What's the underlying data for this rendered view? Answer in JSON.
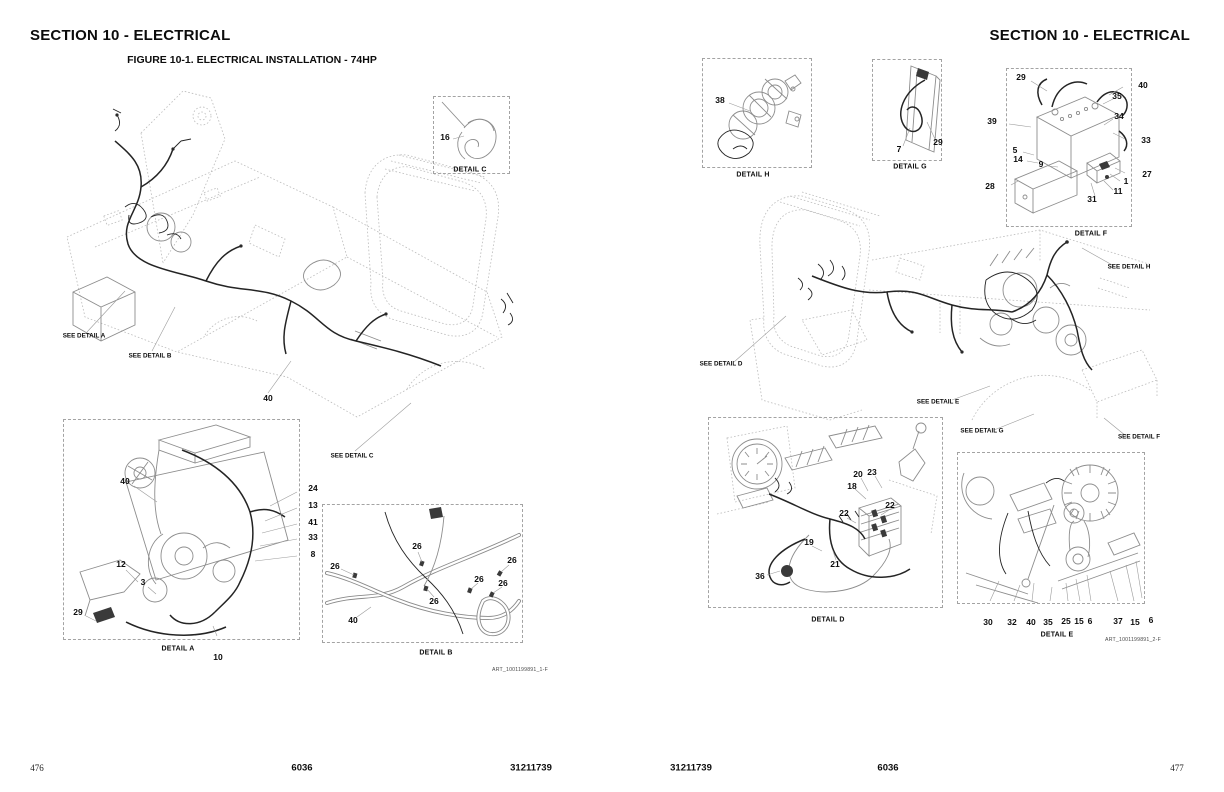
{
  "palette": {
    "paper": "#ffffff",
    "ink": "#0c0c0c",
    "diagram_gray": "#8d8d8d",
    "dashed_box_gray": "#a3a3a3",
    "harness_black": "#242424"
  },
  "left_page": {
    "header": "SECTION 10 - ELECTRICAL",
    "figure_title": "FIGURE 10-1. ELECTRICAL INSTALLATION - 74HP",
    "art_ref": "ART_1001199891_1-F",
    "footer": {
      "page": "476",
      "model": "6036",
      "part": "31211739"
    },
    "callouts": [
      {
        "t": "SEE DETAIL A",
        "x": 84,
        "y": 336,
        "k": "see"
      },
      {
        "t": "SEE DETAIL B",
        "x": 150,
        "y": 356,
        "k": "see"
      },
      {
        "t": "SEE DETAIL C",
        "x": 352,
        "y": 456,
        "k": "see"
      },
      {
        "t": "DETAIL C",
        "x": 470,
        "y": 170,
        "k": "cap"
      },
      {
        "t": "DETAIL A",
        "x": 178,
        "y": 649,
        "k": "cap"
      },
      {
        "t": "DETAIL B",
        "x": 436,
        "y": 653,
        "k": "cap"
      },
      {
        "t": "16",
        "x": 445,
        "y": 137
      },
      {
        "t": "40",
        "x": 268,
        "y": 398
      },
      {
        "t": "40",
        "x": 125,
        "y": 481
      },
      {
        "t": "24",
        "x": 313,
        "y": 488
      },
      {
        "t": "13",
        "x": 313,
        "y": 505
      },
      {
        "t": "41",
        "x": 313,
        "y": 522
      },
      {
        "t": "33",
        "x": 313,
        "y": 537
      },
      {
        "t": "8",
        "x": 313,
        "y": 554
      },
      {
        "t": "12",
        "x": 121,
        "y": 564
      },
      {
        "t": "3",
        "x": 143,
        "y": 582
      },
      {
        "t": "29",
        "x": 78,
        "y": 612
      },
      {
        "t": "10",
        "x": 218,
        "y": 657
      },
      {
        "t": "26",
        "x": 417,
        "y": 546
      },
      {
        "t": "26",
        "x": 335,
        "y": 566
      },
      {
        "t": "26",
        "x": 512,
        "y": 560
      },
      {
        "t": "26",
        "x": 479,
        "y": 579
      },
      {
        "t": "26",
        "x": 503,
        "y": 583
      },
      {
        "t": "26",
        "x": 434,
        "y": 601
      },
      {
        "t": "40",
        "x": 353,
        "y": 620
      }
    ]
  },
  "right_page": {
    "header": "SECTION 10 - ELECTRICAL",
    "art_ref": "ART_1001199891_2-F",
    "footer": {
      "part": "31211739",
      "model": "6036",
      "page": "477"
    },
    "callouts": [
      {
        "t": "DETAIL H",
        "x": 753,
        "y": 175,
        "k": "cap"
      },
      {
        "t": "DETAIL G",
        "x": 910,
        "y": 167,
        "k": "cap"
      },
      {
        "t": "DETAIL F",
        "x": 1091,
        "y": 234,
        "k": "cap"
      },
      {
        "t": "DETAIL D",
        "x": 828,
        "y": 620,
        "k": "cap"
      },
      {
        "t": "DETAIL E",
        "x": 1057,
        "y": 635,
        "k": "cap"
      },
      {
        "t": "SEE DETAIL H",
        "x": 1129,
        "y": 267,
        "k": "see"
      },
      {
        "t": "SEE DETAIL D",
        "x": 721,
        "y": 364,
        "k": "see"
      },
      {
        "t": "SEE DETAIL E",
        "x": 938,
        "y": 402,
        "k": "see"
      },
      {
        "t": "SEE DETAIL G",
        "x": 982,
        "y": 431,
        "k": "see"
      },
      {
        "t": "SEE DETAIL F",
        "x": 1139,
        "y": 437,
        "k": "see"
      },
      {
        "t": "38",
        "x": 720,
        "y": 100
      },
      {
        "t": "7",
        "x": 899,
        "y": 149
      },
      {
        "t": "29",
        "x": 938,
        "y": 142
      },
      {
        "t": "29",
        "x": 1021,
        "y": 77
      },
      {
        "t": "40",
        "x": 1143,
        "y": 85
      },
      {
        "t": "35",
        "x": 1117,
        "y": 96
      },
      {
        "t": "39",
        "x": 992,
        "y": 121
      },
      {
        "t": "34",
        "x": 1119,
        "y": 116
      },
      {
        "t": "33",
        "x": 1146,
        "y": 140
      },
      {
        "t": "5",
        "x": 1015,
        "y": 150
      },
      {
        "t": "14",
        "x": 1018,
        "y": 159
      },
      {
        "t": "9",
        "x": 1041,
        "y": 164
      },
      {
        "t": "27",
        "x": 1147,
        "y": 174
      },
      {
        "t": "28",
        "x": 990,
        "y": 186
      },
      {
        "t": "1",
        "x": 1126,
        "y": 181
      },
      {
        "t": "11",
        "x": 1118,
        "y": 191
      },
      {
        "t": "31",
        "x": 1092,
        "y": 199
      },
      {
        "t": "20",
        "x": 858,
        "y": 474
      },
      {
        "t": "23",
        "x": 872,
        "y": 472
      },
      {
        "t": "18",
        "x": 852,
        "y": 486
      },
      {
        "t": "22",
        "x": 890,
        "y": 505
      },
      {
        "t": "22",
        "x": 844,
        "y": 513
      },
      {
        "t": "19",
        "x": 809,
        "y": 542
      },
      {
        "t": "21",
        "x": 835,
        "y": 564
      },
      {
        "t": "36",
        "x": 760,
        "y": 576
      },
      {
        "t": "30",
        "x": 988,
        "y": 622
      },
      {
        "t": "32",
        "x": 1012,
        "y": 622
      },
      {
        "t": "40",
        "x": 1031,
        "y": 622
      },
      {
        "t": "35",
        "x": 1048,
        "y": 622
      },
      {
        "t": "25",
        "x": 1066,
        "y": 621
      },
      {
        "t": "15",
        "x": 1079,
        "y": 621
      },
      {
        "t": "6",
        "x": 1090,
        "y": 621
      },
      {
        "t": "37",
        "x": 1118,
        "y": 621
      },
      {
        "t": "15",
        "x": 1135,
        "y": 622
      },
      {
        "t": "6",
        "x": 1151,
        "y": 620
      }
    ]
  }
}
